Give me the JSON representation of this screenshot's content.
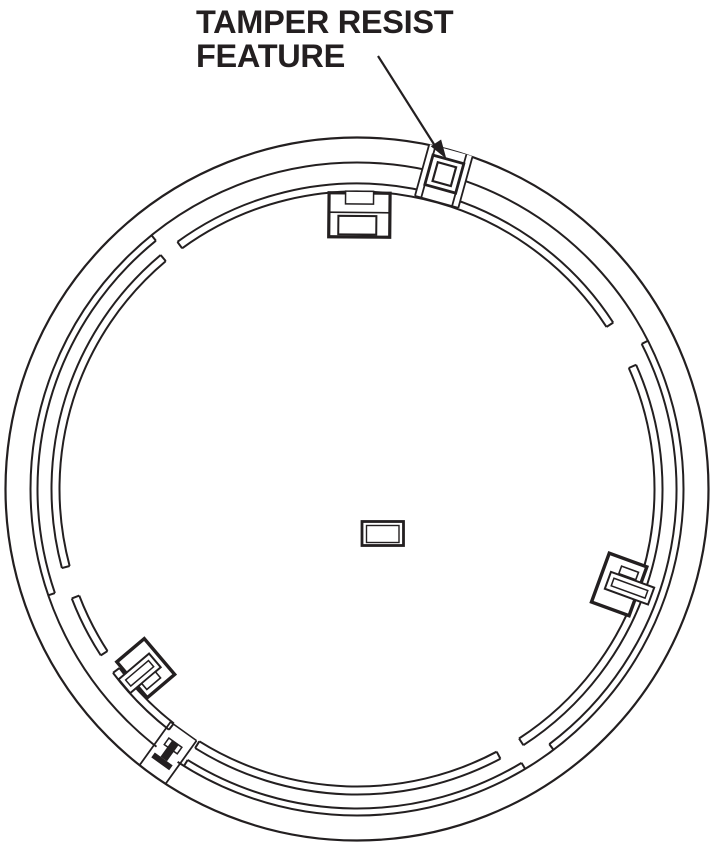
{
  "annotation": {
    "line1": "TAMPER RESIST",
    "line2": "FEATURE"
  },
  "colors": {
    "ink": "#231f20",
    "background": "#ffffff"
  },
  "features": [
    {
      "name": "outer-rim-circle"
    },
    {
      "name": "inner-rim-circle"
    },
    {
      "name": "locking-track-segments"
    },
    {
      "name": "tamper-resist-tab"
    },
    {
      "name": "mounting-clip-top"
    },
    {
      "name": "side-clip-right"
    },
    {
      "name": "side-clip-lower-left"
    },
    {
      "name": "tamper-key-slot"
    },
    {
      "name": "center-knockout"
    },
    {
      "name": "leader-arrow"
    }
  ]
}
